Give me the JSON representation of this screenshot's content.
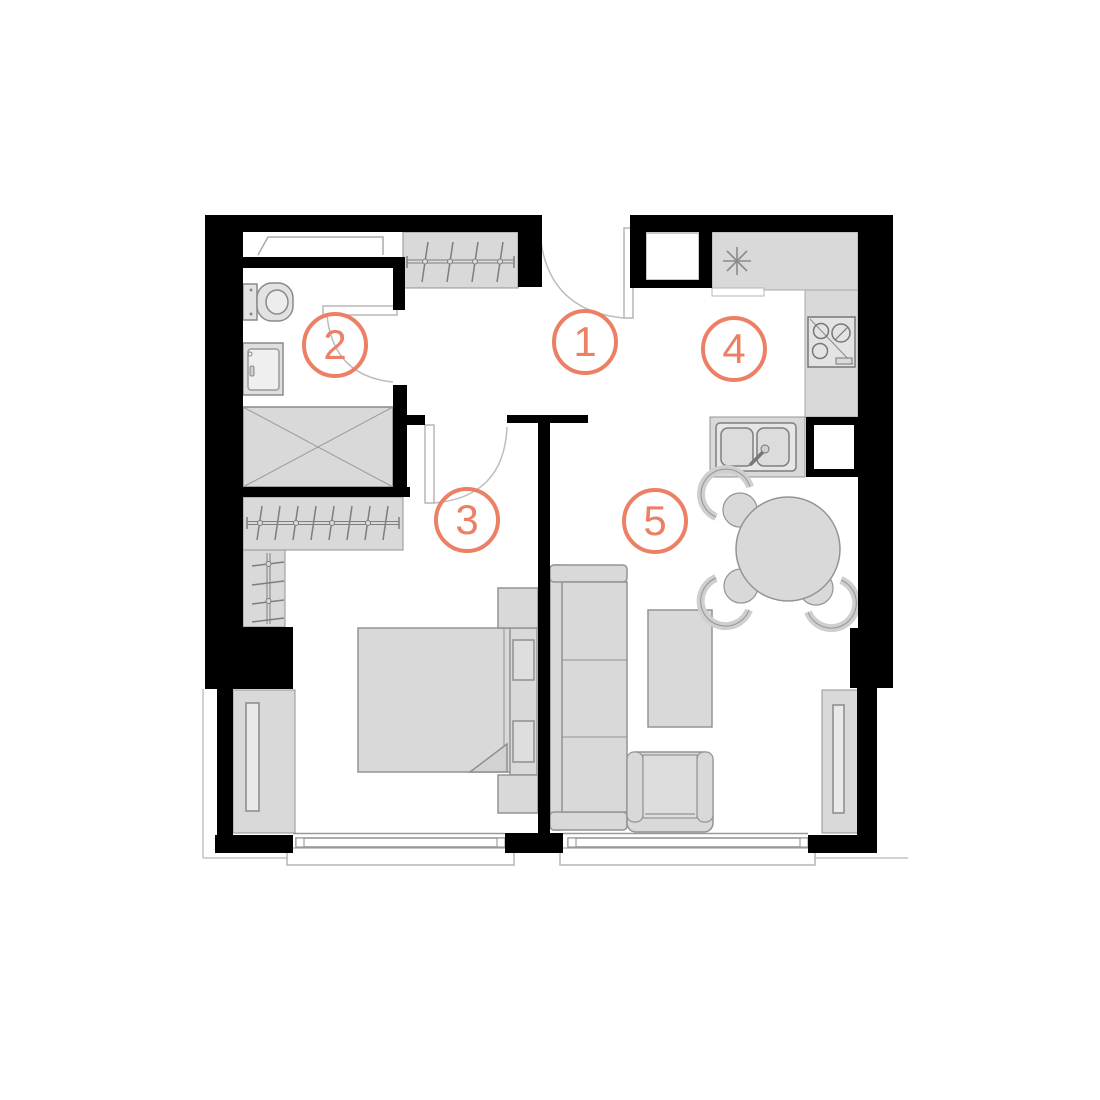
{
  "colors": {
    "accent": "#EC8066",
    "wall": "#000000",
    "furniture_fill": "#D9D9D9",
    "furniture_stroke": "#949494",
    "thin_line": "#AAAAAA"
  },
  "rooms": [
    {
      "label": "1"
    },
    {
      "label": "2"
    },
    {
      "label": "3"
    },
    {
      "label": "4"
    },
    {
      "label": "5"
    }
  ]
}
